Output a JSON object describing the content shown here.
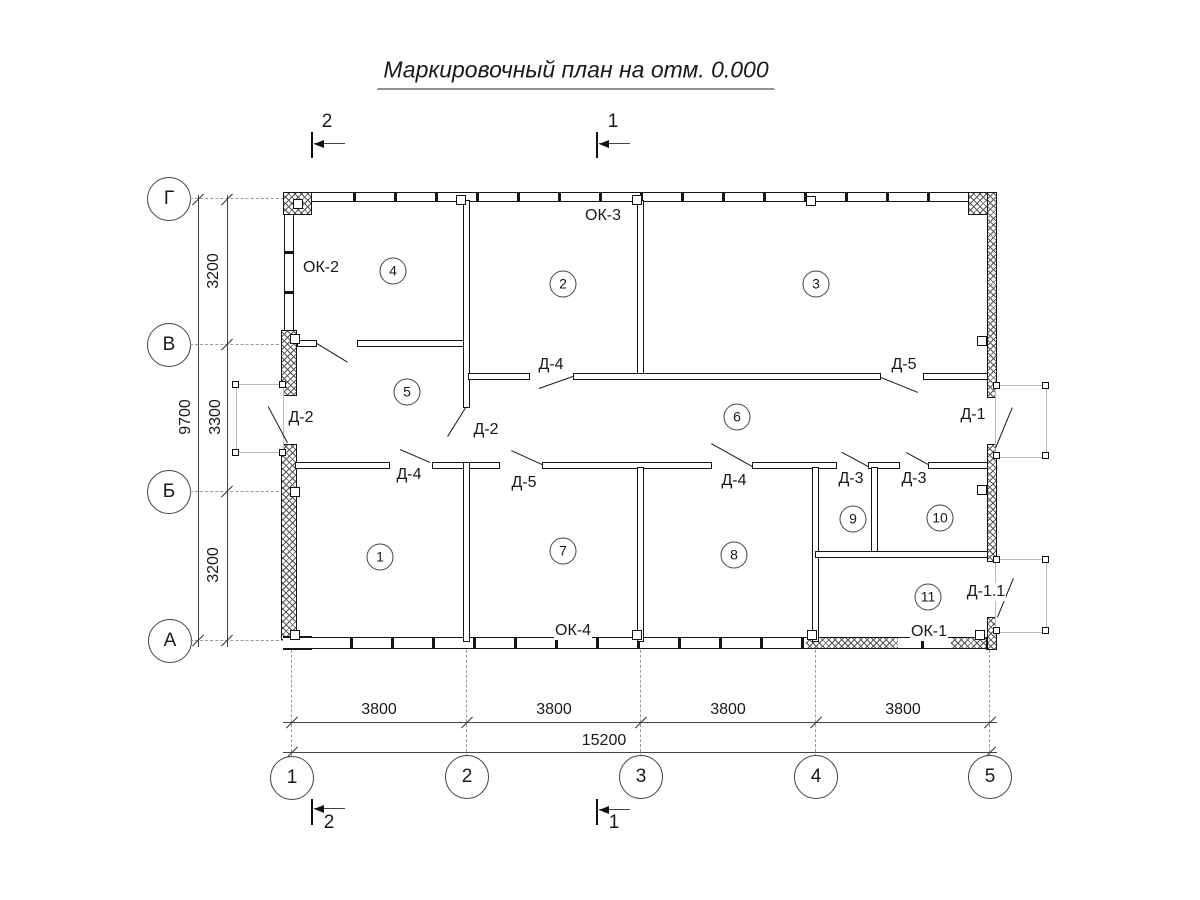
{
  "title": "Маркировочный план на отм. 0.000",
  "plan": {
    "rooms": [
      "1",
      "2",
      "3",
      "4",
      "5",
      "6",
      "7",
      "8",
      "9",
      "10",
      "11"
    ],
    "doors": [
      "Д-2",
      "Д-2",
      "Д-4",
      "Д-5",
      "Д-4",
      "Д-5",
      "Д-4",
      "Д-3",
      "Д-3",
      "Д-1",
      "Д-1.1"
    ],
    "windows": [
      "ОК-2",
      "ОК-3",
      "ОК-4",
      "ОК-1"
    ]
  },
  "axes": {
    "rows": [
      "Г",
      "В",
      "Б",
      "А"
    ],
    "cols": [
      "1",
      "2",
      "3",
      "4",
      "5"
    ]
  },
  "dimensions": {
    "vertical": {
      "segments": [
        "3200",
        "3300",
        "3200"
      ],
      "total": "9700"
    },
    "horizontal": {
      "segments": [
        "3800",
        "3800",
        "3800",
        "3800"
      ],
      "total": "15200"
    }
  },
  "section_markers": {
    "top": [
      "2",
      "1"
    ],
    "bottom": [
      "2",
      "1"
    ]
  },
  "colors": {
    "line": "#1a1a1a",
    "centerline": "#999999",
    "porch_outline": "#bbbbbb",
    "background": "#ffffff"
  }
}
